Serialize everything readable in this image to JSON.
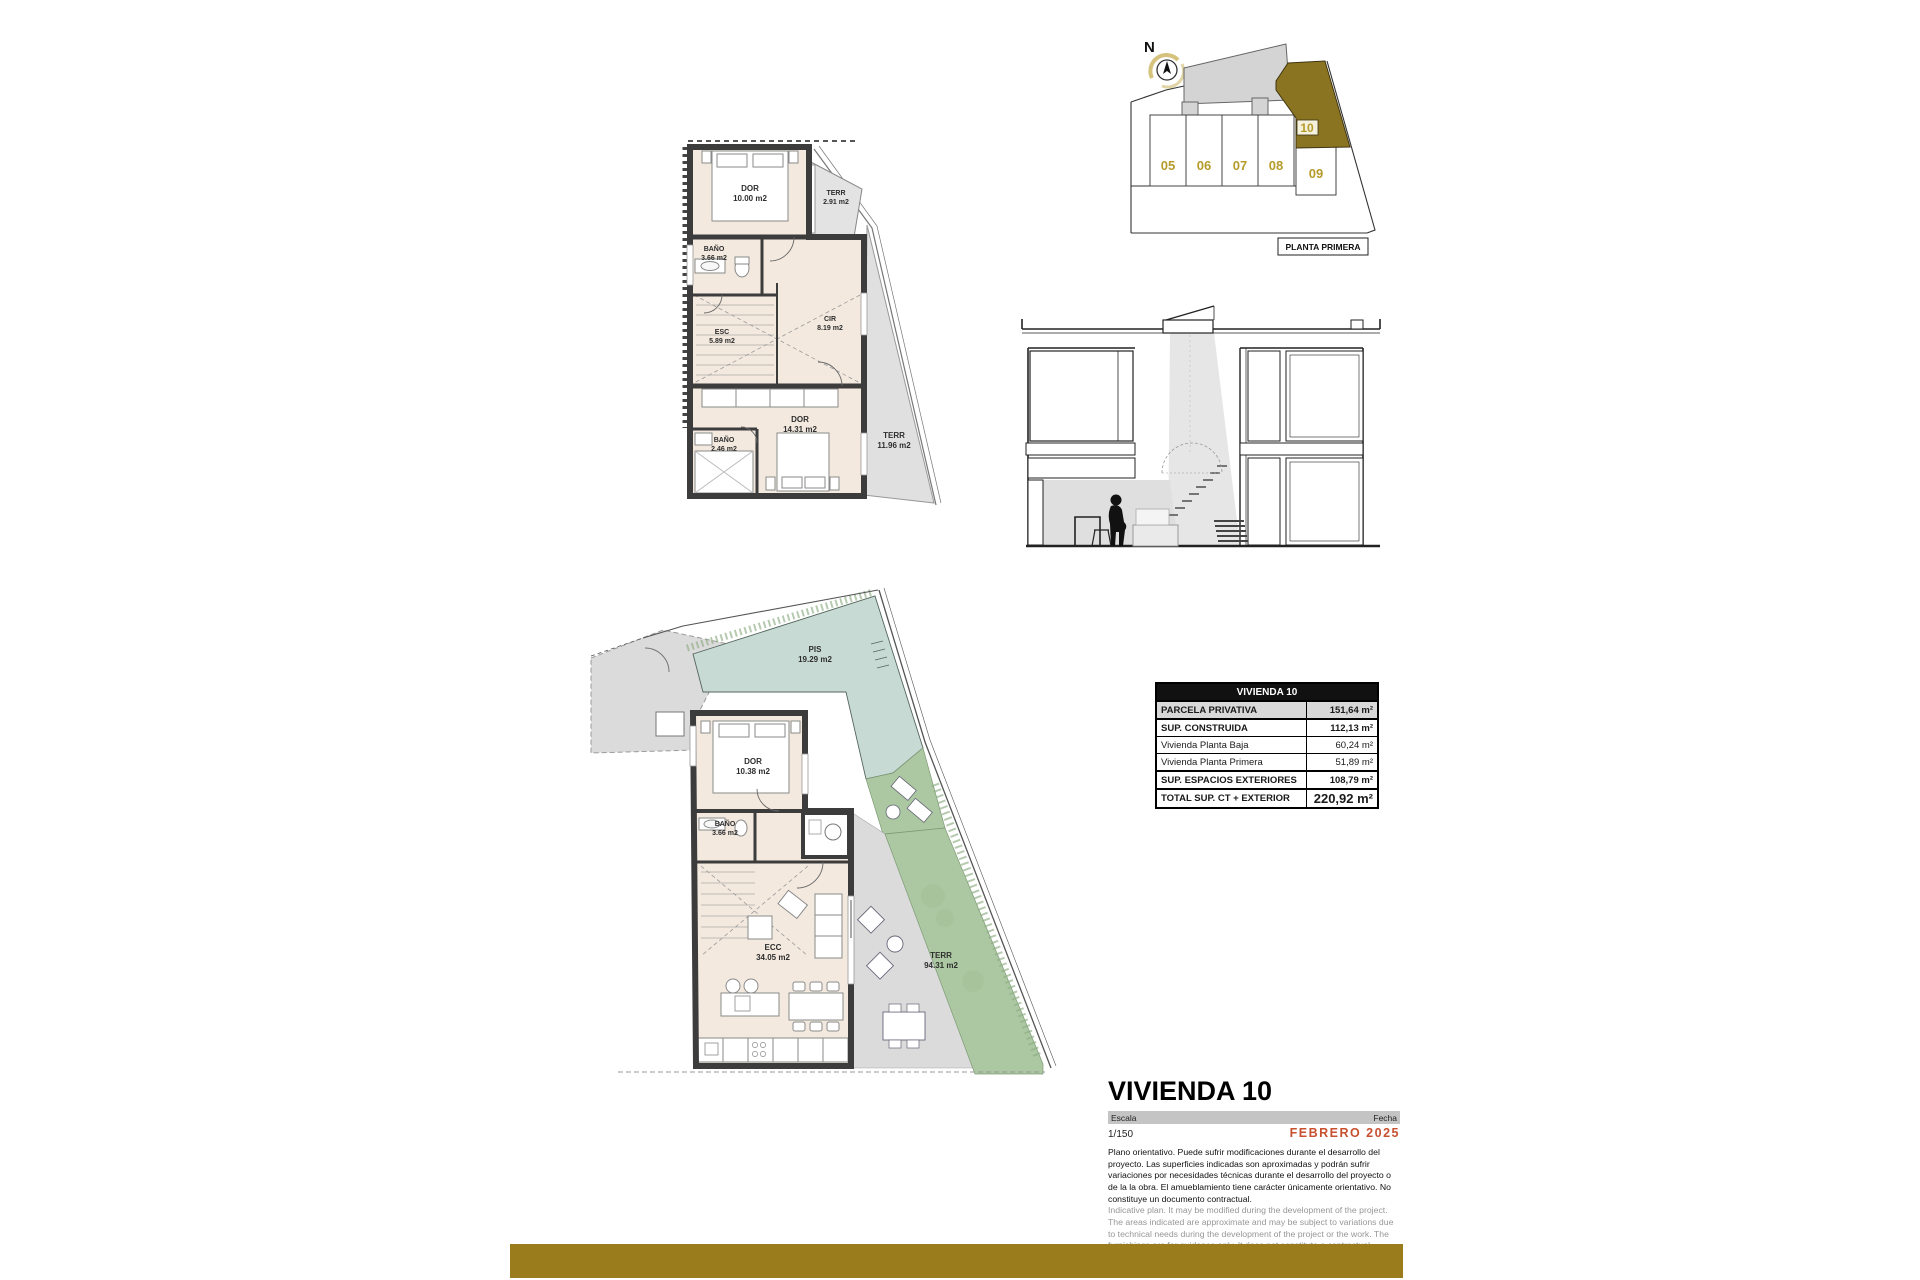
{
  "page": {
    "background": "#ffffff",
    "accent_bar_color": "#9A7C1C",
    "wall_color": "#3c3c3c",
    "interior_color": "#f3e9df",
    "pool_color": "#c7dbd4",
    "garden_color": "#acc8a2",
    "paving_color": "#dbdbdb"
  },
  "site_plan": {
    "north_label": "N",
    "caption": "PLANTA PRIMERA",
    "highlight_color": "#8a7321",
    "number_color": "#b59b2a",
    "units": [
      {
        "id": "05"
      },
      {
        "id": "06"
      },
      {
        "id": "07"
      },
      {
        "id": "08"
      },
      {
        "id": "09"
      },
      {
        "id": "10"
      }
    ]
  },
  "first_floor_plan": {
    "rooms": [
      {
        "name": "DOR",
        "area": "10.00 m2"
      },
      {
        "name": "TERR",
        "area": "2.91 m2"
      },
      {
        "name": "BAÑO",
        "area": "3.66 m2"
      },
      {
        "name": "ESC",
        "area": "5.89 m2"
      },
      {
        "name": "CIR",
        "area": "8.19 m2"
      },
      {
        "name": "DOR",
        "area": "14.31 m2"
      },
      {
        "name": "BAÑO",
        "area": "2.46 m2"
      },
      {
        "name": "TERR",
        "area": "11.96 m2"
      }
    ]
  },
  "ground_floor_plan": {
    "rooms": [
      {
        "name": "PIS",
        "area": "19.29 m2"
      },
      {
        "name": "DOR",
        "area": "10.38 m2"
      },
      {
        "name": "BAÑO",
        "area": "3.66 m2"
      },
      {
        "name": "ECC",
        "area": "34.05 m2"
      },
      {
        "name": "TERR",
        "area": "94.31 m2"
      }
    ]
  },
  "summary_table": {
    "header": "VIVIENDA 10",
    "rows": [
      {
        "label": "PARCELA PRIVATIVA",
        "value": "151,64 m²"
      },
      {
        "label": "SUP. CONSTRUIDA",
        "value": "112,13 m²"
      },
      {
        "label": "Vivienda Planta Baja",
        "value": "60,24 m²"
      },
      {
        "label": "Vivienda Planta Primera",
        "value": "51,89 m²"
      },
      {
        "label": "SUP. ESPACIOS EXTERIORES",
        "value": "108,79 m²"
      },
      {
        "label": "TOTAL SUP. CT + EXTERIOR",
        "value": "220,92 m²"
      }
    ]
  },
  "title_block": {
    "title": "VIVIENDA 10",
    "scale_label": "Escala",
    "scale_value": "1/150",
    "date_label": "Fecha",
    "date_value": "FEBRERO 2025",
    "date_color": "#c7502f",
    "disclaimer_es": "Plano orientativo. Puede sufrir modificaciones durante el desarrollo del proyecto. Las superficies indicadas son aproximadas y podrán sufrir variaciones por necesidades técnicas durante el desarrollo del proyecto o de la la obra. El amueblamiento tiene carácter únicamente orientativo. No constituye un documento contractual.",
    "disclaimer_en": "Indicative plan. It may be modified during the development of the project. The areas indicated are approximate and may be subject to variations due to technical needs during the development of the project or the work. The furnishings are for guidance only. It does not constitute a contractual document."
  }
}
